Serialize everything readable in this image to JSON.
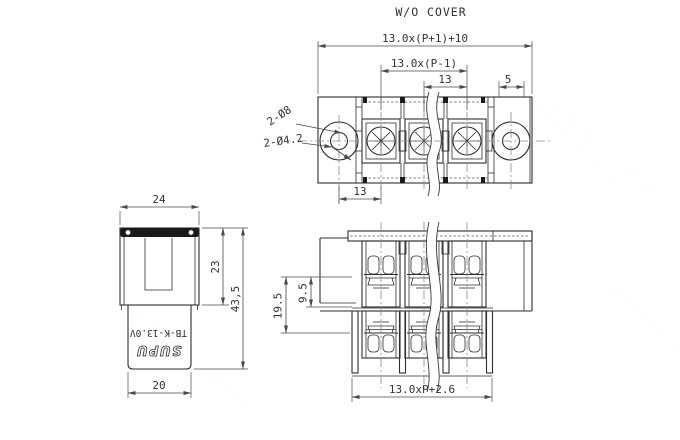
{
  "drawing": {
    "title": "W/O COVER",
    "top_view": {
      "dim_total": "13.0x(P+1)+10",
      "dim_inner": "13.0x(P-1)",
      "dim_pitch": "13",
      "dim_end": "5",
      "leader_boss": "2-Ø8",
      "leader_hole": "2-Ø4.2",
      "dim_hole_to_pole": "13"
    },
    "side_view": {
      "dim_width": "24",
      "dim_upper_height": "23",
      "dim_total_height": "43,5",
      "dim_bottom_width": "20",
      "brand_logo": "SUPU",
      "brand_model": "TB-K-13.0V"
    },
    "front_view": {
      "dim_row_height": "19.5",
      "dim_half_height": "9.5",
      "dim_center_width": "13.0xP+2.6"
    },
    "colors": {
      "line": "#2e2e2e",
      "dimension": "#4a4a4a",
      "centerline": "#8a8a8a",
      "cap_fill": "#1a1a1a",
      "background": "#ffffff",
      "watermark": "#c7cbd8"
    },
    "watermark_text": "· ˙ · ˙ · ˙ · ˙ · ˙ · ˙ ·"
  }
}
